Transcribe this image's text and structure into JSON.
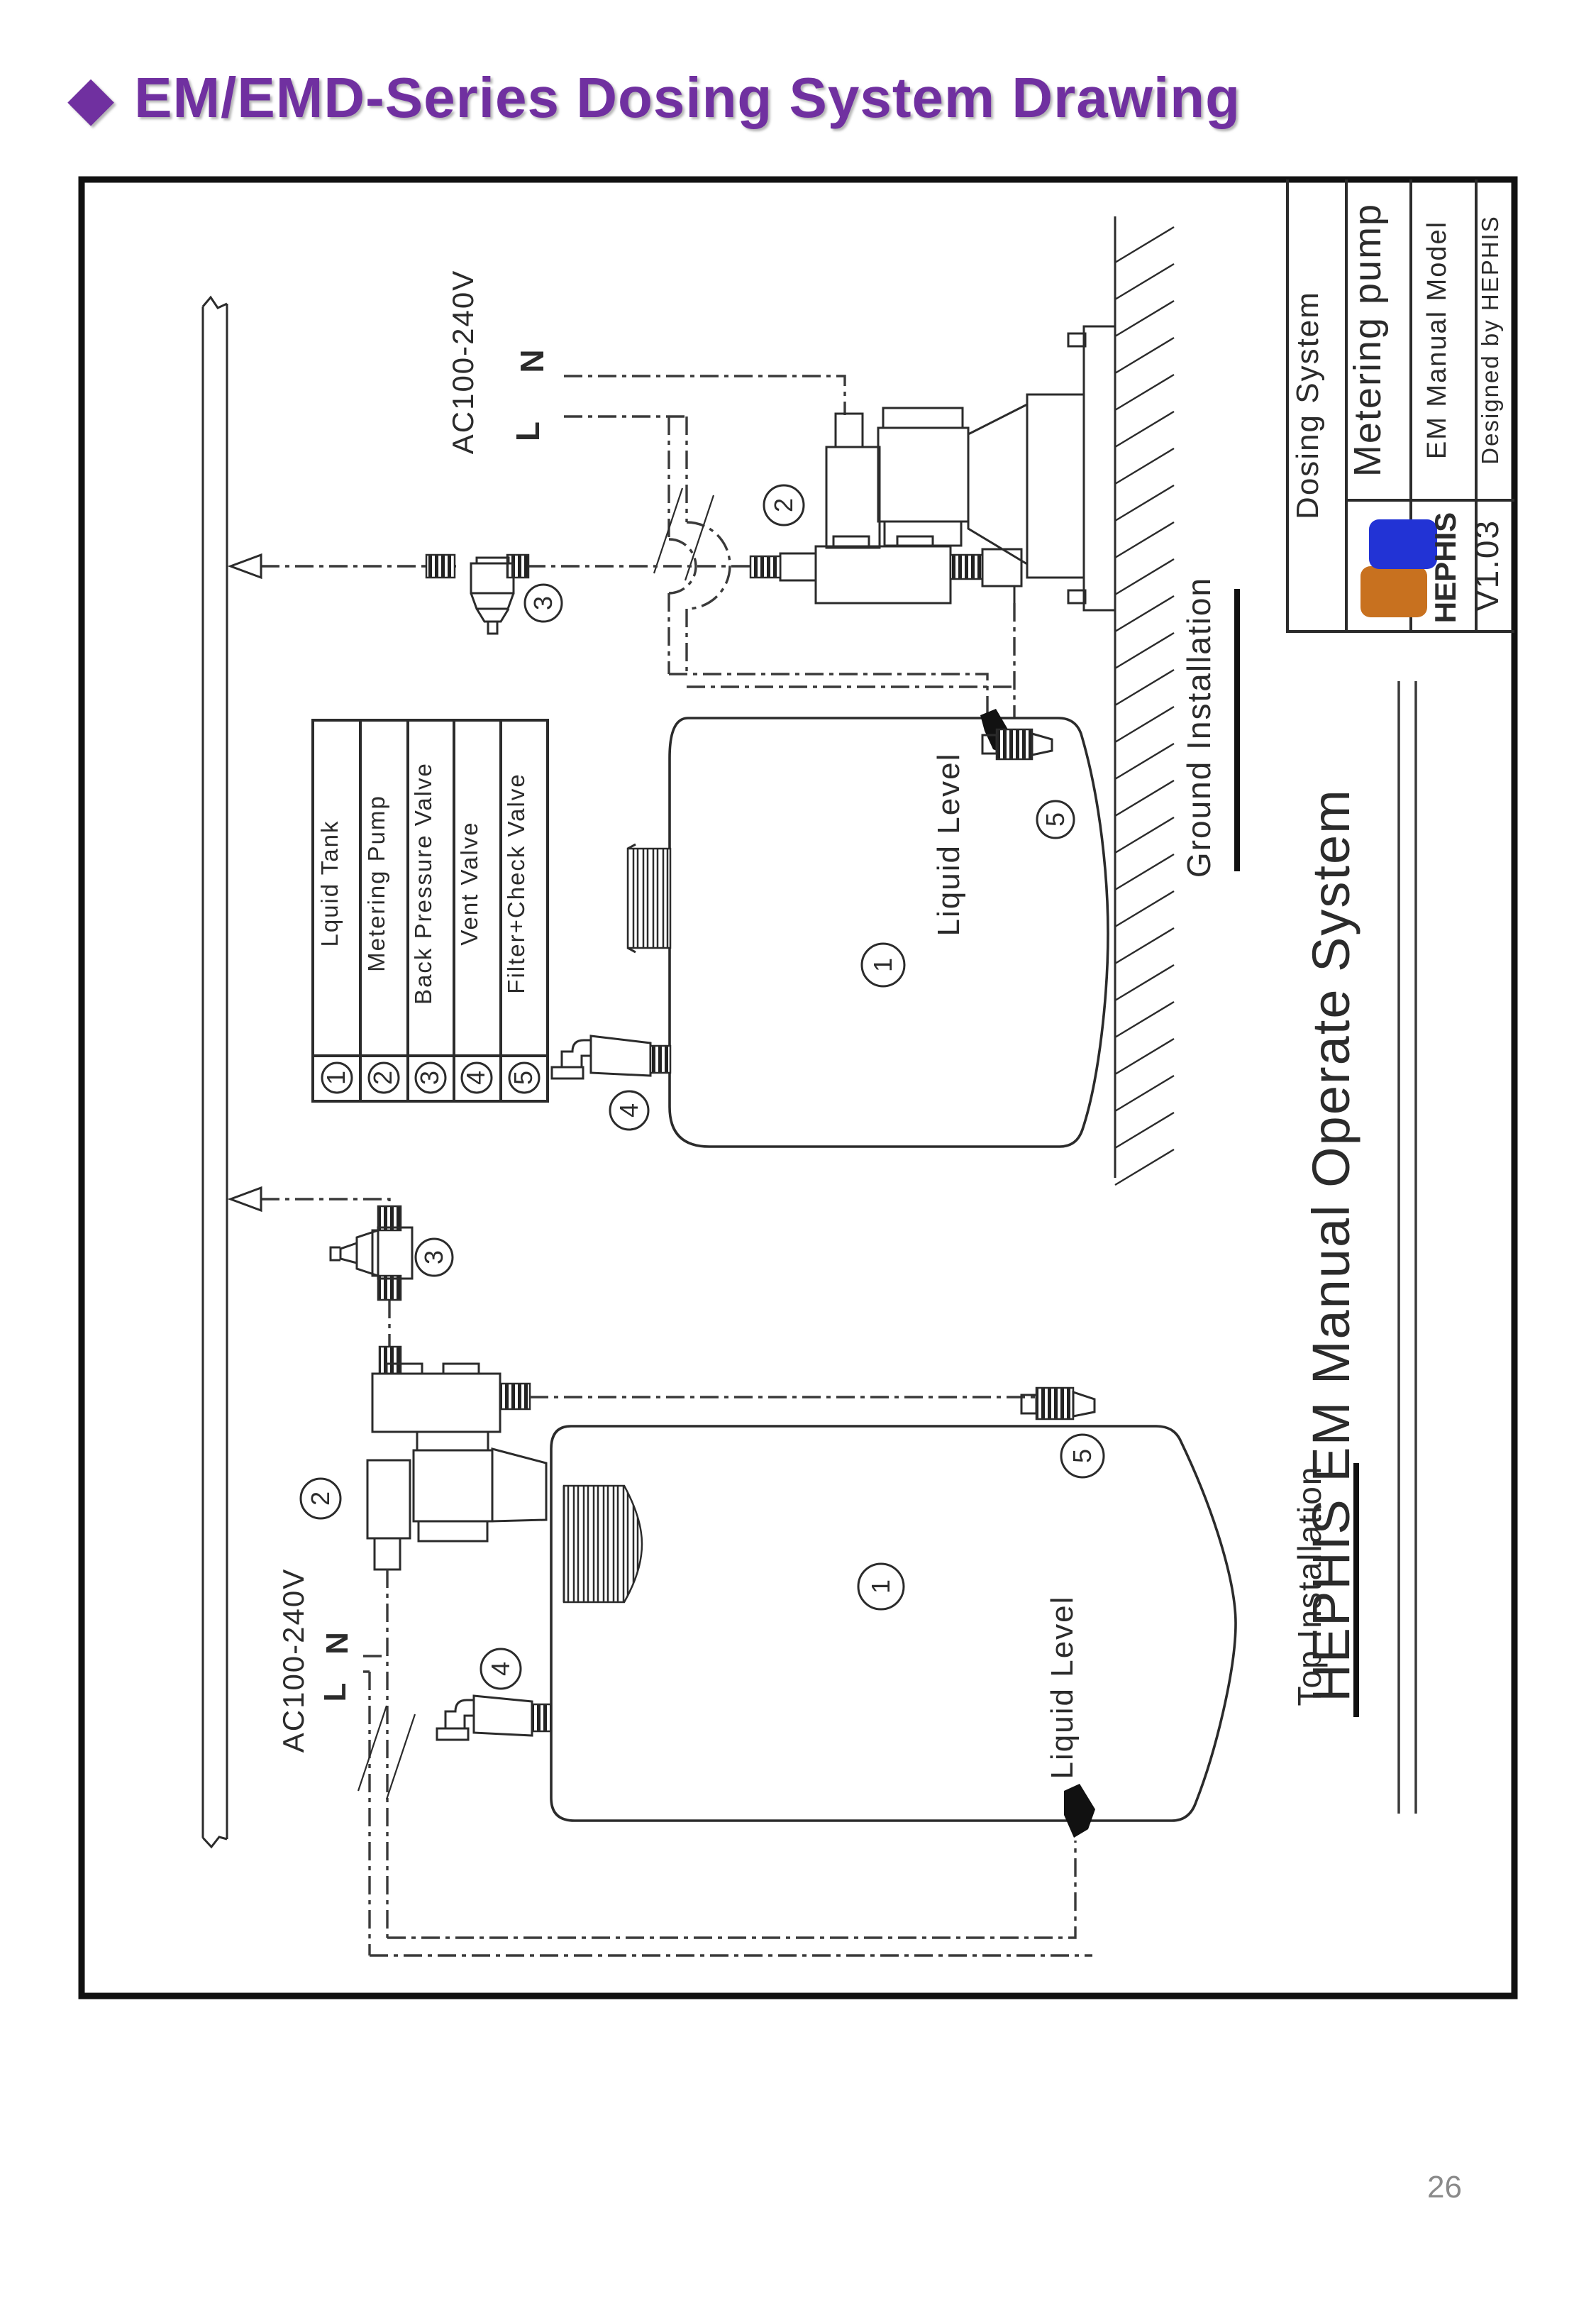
{
  "page": {
    "bullet": "◆",
    "title": "EM/EMD-Series Dosing System Drawing",
    "page_number": "26",
    "accent_color": "#7030A0"
  },
  "title_block": {
    "system": "Dosing System",
    "product": "Metering pump",
    "model": "EM Manual Model",
    "designer": "Designed by HEPHIS",
    "brand": "HEPHIS",
    "version": "V1.03",
    "brand_color": "#2230cc",
    "logo_blue": "#2233d5",
    "logo_orange": "#c8711f"
  },
  "legend": {
    "items": [
      {
        "num": "1",
        "label": "Lquid Tank"
      },
      {
        "num": "2",
        "label": "Metering Pump"
      },
      {
        "num": "3",
        "label": "Back Pressure Valve"
      },
      {
        "num": "4",
        "label": "Vent Valve"
      },
      {
        "num": "5",
        "label": "Filter+Check Valve"
      }
    ]
  },
  "diagram": {
    "power_label": "AC100-240V",
    "line_label": "L",
    "neutral_label": "N",
    "liquid_level_label": "Liquid Level",
    "ground_section_label": "Ground Installation",
    "top_section_label": "Top Installation",
    "watermark": "HEPHIS EM Manual Operate System",
    "callouts": {
      "tank": "1",
      "pump": "2",
      "back_pressure_valve": "3",
      "vent_valve": "4",
      "filter_check_valve": "5"
    }
  }
}
